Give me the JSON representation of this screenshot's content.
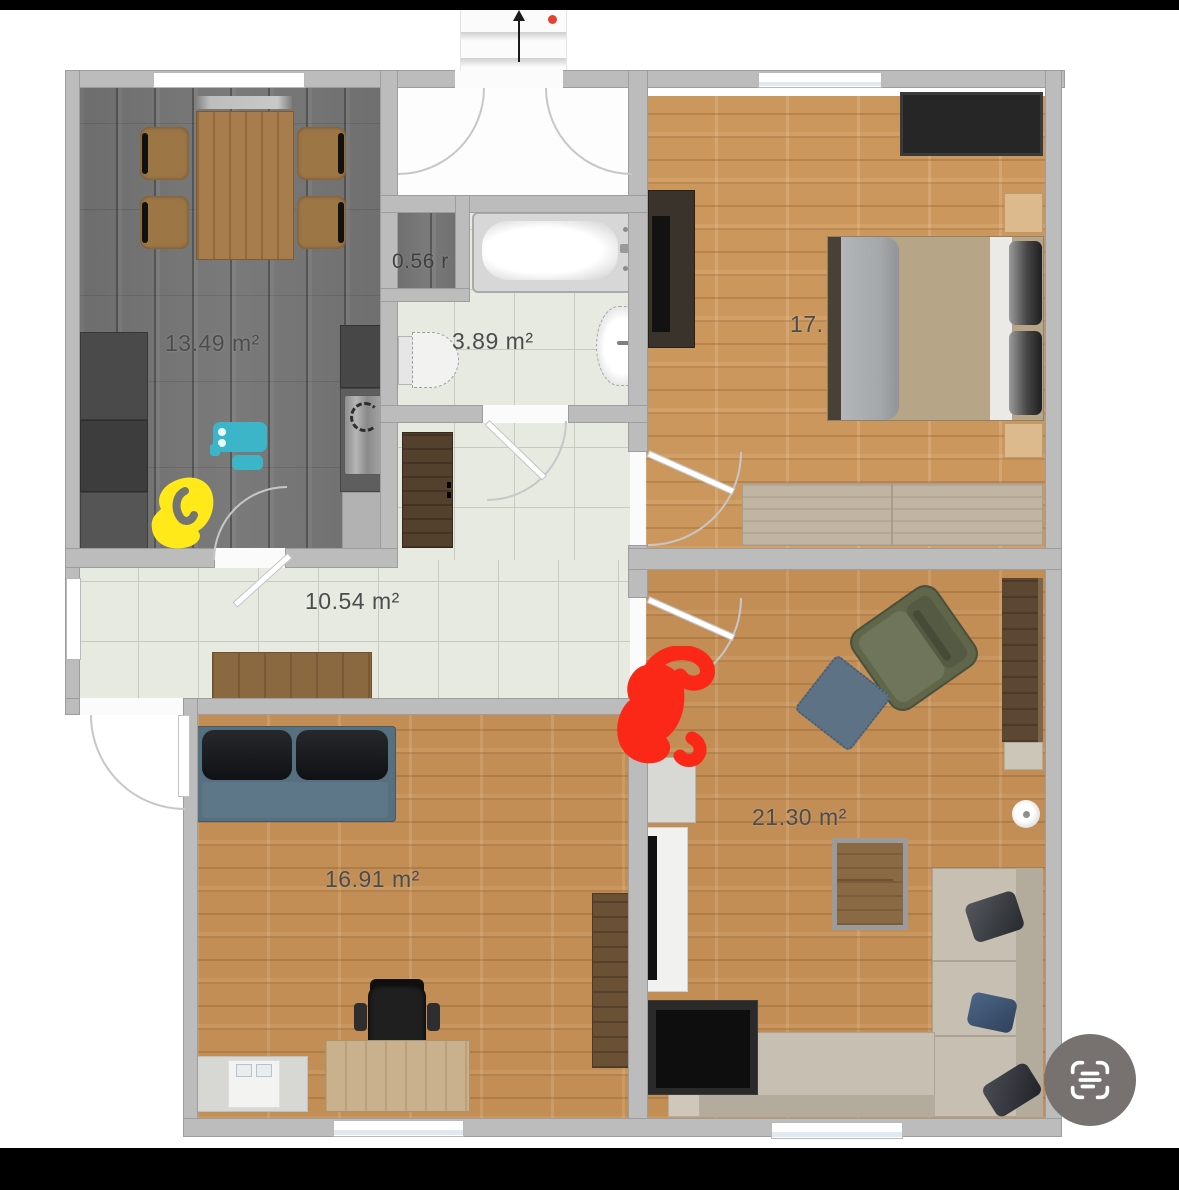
{
  "viewer": {
    "top_bar_color": "#000000",
    "bottom_bar_color": "#000000",
    "background_color": "#ffffff",
    "scan_button": {
      "icon": "scan-text-icon",
      "bg_color": "#77726f",
      "glyph_color": "#ffffff"
    }
  },
  "floor_plan": {
    "north_arrow": {
      "icon": "north-arrow-icon",
      "direction": "up"
    },
    "recording_dot_color": "#e8402e",
    "rooms": {
      "kitchen": {
        "name": "kitchen-dining",
        "area_label": "13.49 m²"
      },
      "storage": {
        "name": "storage-closet",
        "area_label": "0.56 r"
      },
      "bathroom": {
        "name": "bathroom",
        "area_label": "3.89 m²"
      },
      "hallway": {
        "name": "hallway",
        "area_label": "10.54 m²"
      },
      "bedroom": {
        "name": "bedroom",
        "area_label": "17."
      },
      "office": {
        "name": "office-room",
        "area_label": "16.91 m²"
      },
      "living": {
        "name": "living-room",
        "area_label": "21.30 m²"
      }
    },
    "annotations": {
      "yellow_marker_color": "#ffe919",
      "cyan_marker_color": "#3cb5c8",
      "red_marker_color": "#fb2818"
    },
    "colors": {
      "wall": "#bcbcbc",
      "kitchen_floor": "#737373",
      "tile_floor": "#e7eae1",
      "wood_floor": "#c28e55"
    }
  }
}
